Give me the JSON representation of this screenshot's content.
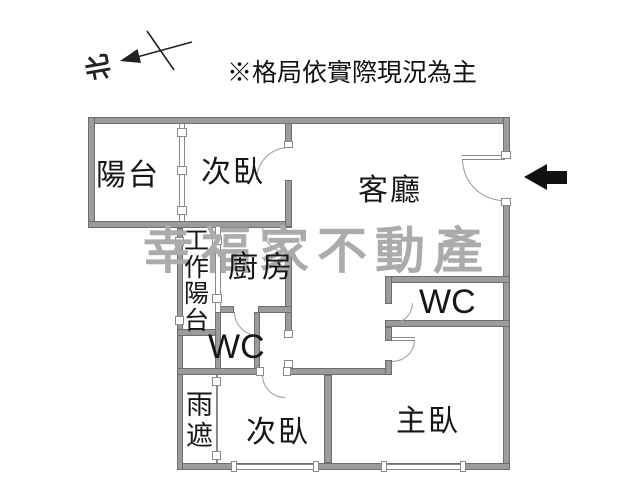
{
  "annotations": {
    "caption": "※格局依實際現況為主",
    "north_label": "北",
    "watermark": "幸福家不動產"
  },
  "rooms": [
    {
      "id": "balcony",
      "label": "陽台"
    },
    {
      "id": "bedroom-top",
      "label": "次臥"
    },
    {
      "id": "living-room",
      "label": "客廳"
    },
    {
      "id": "work-balcony",
      "label": "工作陽台",
      "orientation": "vertical"
    },
    {
      "id": "kitchen",
      "label": "廚房"
    },
    {
      "id": "wc-left",
      "label": "WC"
    },
    {
      "id": "rain-shelter",
      "label": "雨遮",
      "orientation": "vertical"
    },
    {
      "id": "bedroom-bottom",
      "label": "次臥"
    },
    {
      "id": "wc-right",
      "label": "WC"
    },
    {
      "id": "master-bedroom",
      "label": "主臥"
    }
  ],
  "colors": {
    "wall": "#9b9b9b",
    "wall_edge": "#6e6e6e",
    "thin_line": "#8a8a8a",
    "watermark": "#ababab",
    "text": "#161616",
    "entrance_arrow": "#111111",
    "background": "#ffffff"
  }
}
